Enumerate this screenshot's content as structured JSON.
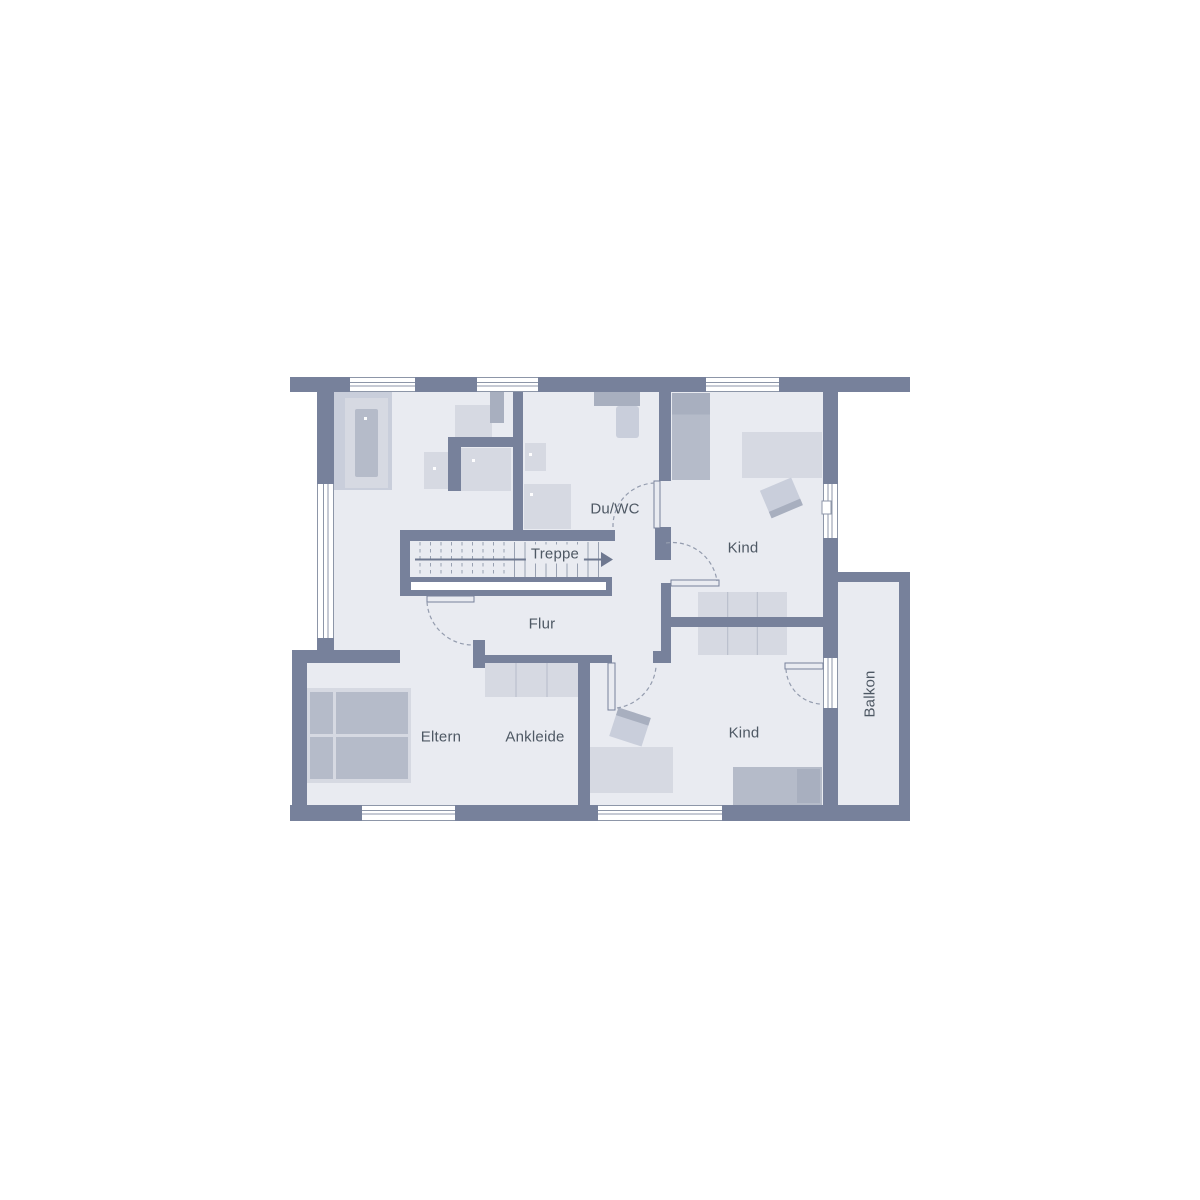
{
  "rooms": {
    "du_wc": "Du/WC",
    "treppe": "Treppe",
    "kind_upper": "Kind",
    "flur": "Flur",
    "eltern": "Eltern",
    "ankleide": "Ankleide",
    "kind_lower": "Kind",
    "balkon": "Balkon"
  },
  "colors": {
    "wall": "#77819b",
    "floor": "#e9ebf1",
    "furniture_light": "#d6d9e2",
    "furniture_midlight": "#c9cedb",
    "furniture_medium": "#b5bbc9",
    "furniture_dark": "#a8afbf",
    "window_line": "#8d96a8",
    "door_arc": "#949cae",
    "label_text": "#4e5864"
  }
}
